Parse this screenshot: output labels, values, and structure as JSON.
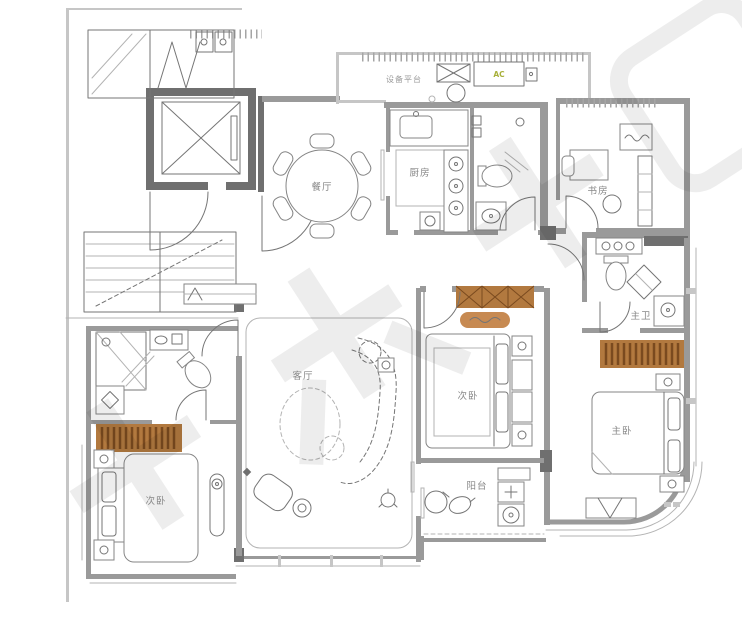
{
  "labels": {
    "dining": "餐厅",
    "kitchen": "厨房",
    "living": "客厅",
    "study": "书房",
    "master_bath": "主卫",
    "master_bedroom": "主卧",
    "bedroom_middle": "次卧",
    "bedroom_left": "次卧",
    "balcony": "阳台",
    "equipment_platform": "设备平台",
    "ac_unit": "AC"
  },
  "colors": {
    "wall": "#9a9a9a",
    "wall_dark": "#6f6f6f",
    "wardrobe_fill": "#b2793f",
    "wardrobe_stripe": "#7a4a1f",
    "bench_fill": "#c78a52",
    "ac_text": "#a8b03a",
    "label_text": "#878787",
    "watermark": "#dcdcdc"
  }
}
